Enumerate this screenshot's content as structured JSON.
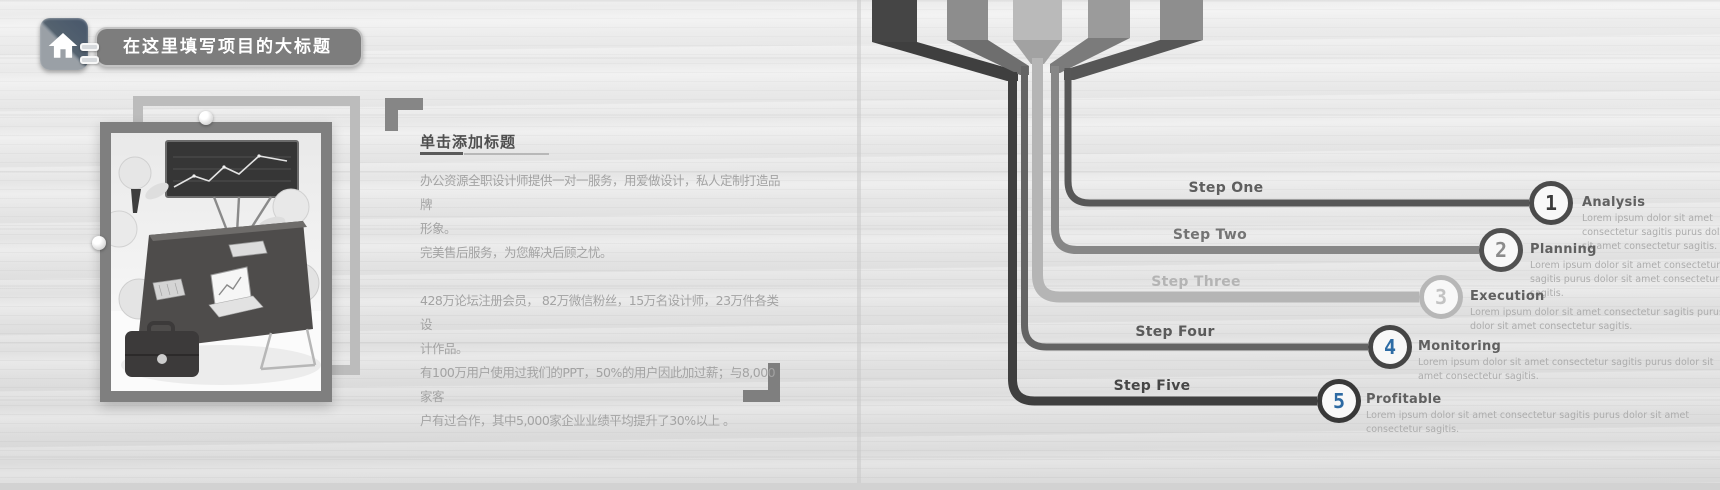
{
  "left_slide": {
    "header": {
      "icon": "home-icon",
      "title": "在这里填写项目的大标题"
    },
    "content": {
      "heading": "单击添加标题",
      "body": "办公资源全职设计师提供一对一服务，用爱做设计，私人定制打造品牌\n形象。\n完美售后服务，为您解决后顾之忧。\n\n428万论坛注册会员， 82万微信粉丝，15万名设计师，23万件各类设\n计作品。\n有100万用户使用过我们的PPT，50%的用户因此加过薪；与8,000家客\n户有过合作，其中5,000家企业业绩平均提升了30%以上 。"
    }
  },
  "right_slide": {
    "steps": [
      {
        "step_label": "Step One",
        "number": "1",
        "title": "Analysis",
        "description": "Lorem ipsum dolor sit amet consectetur sagitis purus dolor sit amet consectetur sagitis.",
        "line_color": "#575757",
        "ribbon_color": "#8e8e8e",
        "fold_color": "#565656",
        "ring_color": "#4a4a4a",
        "number_color": "#3a3a3a",
        "label_color": "#5e5e5e"
      },
      {
        "step_label": "Step Two",
        "number": "2",
        "title": "Planning",
        "description": "Lorem ipsum dolor sit amet consectetur sagitis purus dolor sit amet consectetur sagitis.",
        "line_color": "#878787",
        "ribbon_color": "#9b9b9b",
        "fold_color": "#7b7b7b",
        "ring_color": "#515151",
        "number_color": "#8c8c8c",
        "label_color": "#747474"
      },
      {
        "step_label": "Step Three",
        "number": "3",
        "title": "Execution",
        "description": "Lorem ipsum dolor sit amet consectetur sagitis purus dolor sit amet consectetur sagitis.",
        "line_color": "#b5b5b5",
        "ribbon_color": "#bababa",
        "fold_color": "#a2a2a2",
        "ring_color": "#b7b7b7",
        "number_color": "#c3c3c3",
        "label_color": "#b4b4b4"
      },
      {
        "step_label": "Step Four",
        "number": "4",
        "title": "Monitoring",
        "description": "Lorem ipsum dolor sit amet consectetur sagitis purus dolor sit amet consectetur sagitis.",
        "line_color": "#646464",
        "ribbon_color": "#8d8d8d",
        "fold_color": "#6e6e6e",
        "ring_color": "#454545",
        "number_color": "#2e6ca5",
        "label_color": "#5a5a5a"
      },
      {
        "step_label": "Step Five",
        "number": "5",
        "title": "Profitable",
        "description": "Lorem ipsum dolor sit amet consectetur sagitis purus dolor sit amet consectetur sagitis.",
        "line_color": "#3f3f3f",
        "ribbon_color": "#454545",
        "fold_color": "#3f3f3f",
        "ring_color": "#383838",
        "number_color": "#2d6aa3",
        "label_color": "#464646"
      }
    ]
  },
  "colors": {
    "accent_blue": "#2e6ca5",
    "title_pill_bg": "#7d7d7d",
    "frame_dark": "#7f7f7f",
    "frame_light": "#bcbcbc",
    "heading_text": "#4f4f4f",
    "body_text": "#a3a3a3",
    "step_title_text": "#606060",
    "step_desc_text": "#acacac",
    "background_wood": "#e9e9e9"
  }
}
